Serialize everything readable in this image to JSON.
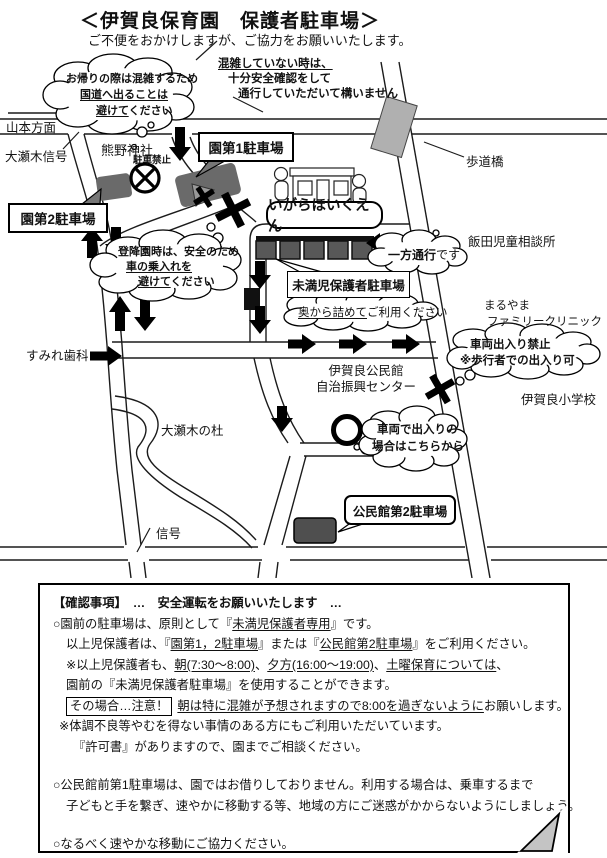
{
  "title": "＜伊賀良保育園　保護者駐車場＞",
  "subtitle": "ご不便をおかけしますが、ご協力をお願いいたします。",
  "map": {
    "labels": {
      "yamamoto": "山本方面",
      "osegi_signal": "大瀬木信号",
      "kumano": "熊野神社",
      "no_parking": "駐車禁止",
      "lot1": "園第1駐車場",
      "lot2": "園第2駐車場",
      "school": "いがらほいくえん",
      "footbridge": "歩道橋",
      "iida": "飯田児童相談所",
      "mimanji": "未満児保護者駐車場",
      "maruyama1": "まるやま",
      "maruyama2": "ファミリークリニック",
      "sumire": "すみれ歯科",
      "kominkan1": "伊賀良公民館",
      "kominkan2": "自治振興センター",
      "elementary": "伊賀良小学校",
      "mori": "大瀬木の杜",
      "signal": "信号",
      "lot_kominkan2": "公民館第2駐車場"
    },
    "clouds": {
      "homeward": {
        "l1": "お帰りの際は混雑するため",
        "l2": "国道へ出ることは",
        "l3u": "避けて",
        "l3r": "ください"
      },
      "notcrowded": {
        "l1": "混雑していない時は、",
        "l2": "十分安全確認をして",
        "l3": "通行していただいて構いません"
      },
      "dropoff": {
        "l1": "登降園時は、安全のため",
        "l2": "車の乗入れを",
        "l3u": "避けて",
        "l3r": "ください"
      },
      "fillback": {
        "u": "奥から詰めて",
        "r": "ご利用ください"
      },
      "oneway": {
        "b": "一方通行",
        "r": "です"
      },
      "novehicle": {
        "l1": "車両出入り禁止",
        "l2": "※歩行者での出入り可"
      },
      "vehicleentry": {
        "l1": "車両で出入りの",
        "l2": "場合はこちらから"
      }
    }
  },
  "notice": {
    "heading": "【確認事項】　…　安全運転をお願いいたします　…",
    "p1a": "○園前の駐車場は、原則として『",
    "p1u": "未満児保護者専用",
    "p1b": "』です。",
    "p2a": "以上児保護者は、『",
    "p2u1": "園第1，2駐車場",
    "p2b": "』または『",
    "p2u2": "公民館第2駐車場",
    "p2c": "』をご利用ください。",
    "p3a": "※以上児保護者も、",
    "p3u1": "朝(7:30～8:00)",
    "p3b": "、",
    "p3u2": "夕方(16:00～19:00)",
    "p3c": "、",
    "p3u3": "土曜保育については",
    "p3d": "、",
    "p4": "園前の『未満児保護者駐車場』を使用することができます。",
    "p5box": "その場合…注意！",
    "p5u": "朝は特に混雑が予想されますので8:00を過ぎないように",
    "p5b": "お願いします。",
    "p6": "※体調不良等やむを得ない事情のある方にもご利用いただいています。",
    "p7": "『許可書』がありますので、園までご相談ください。",
    "p8a": "○公民館前第1駐車場は、園ではお借りしておりません。利用する場合は、乗車するまで",
    "p8b": "子どもと手を繋ぎ、速やかに移動する等、地域の方にご迷惑がかからないようにしましょう。",
    "p9": "○なるべく速やかな移動にご協力ください。"
  }
}
